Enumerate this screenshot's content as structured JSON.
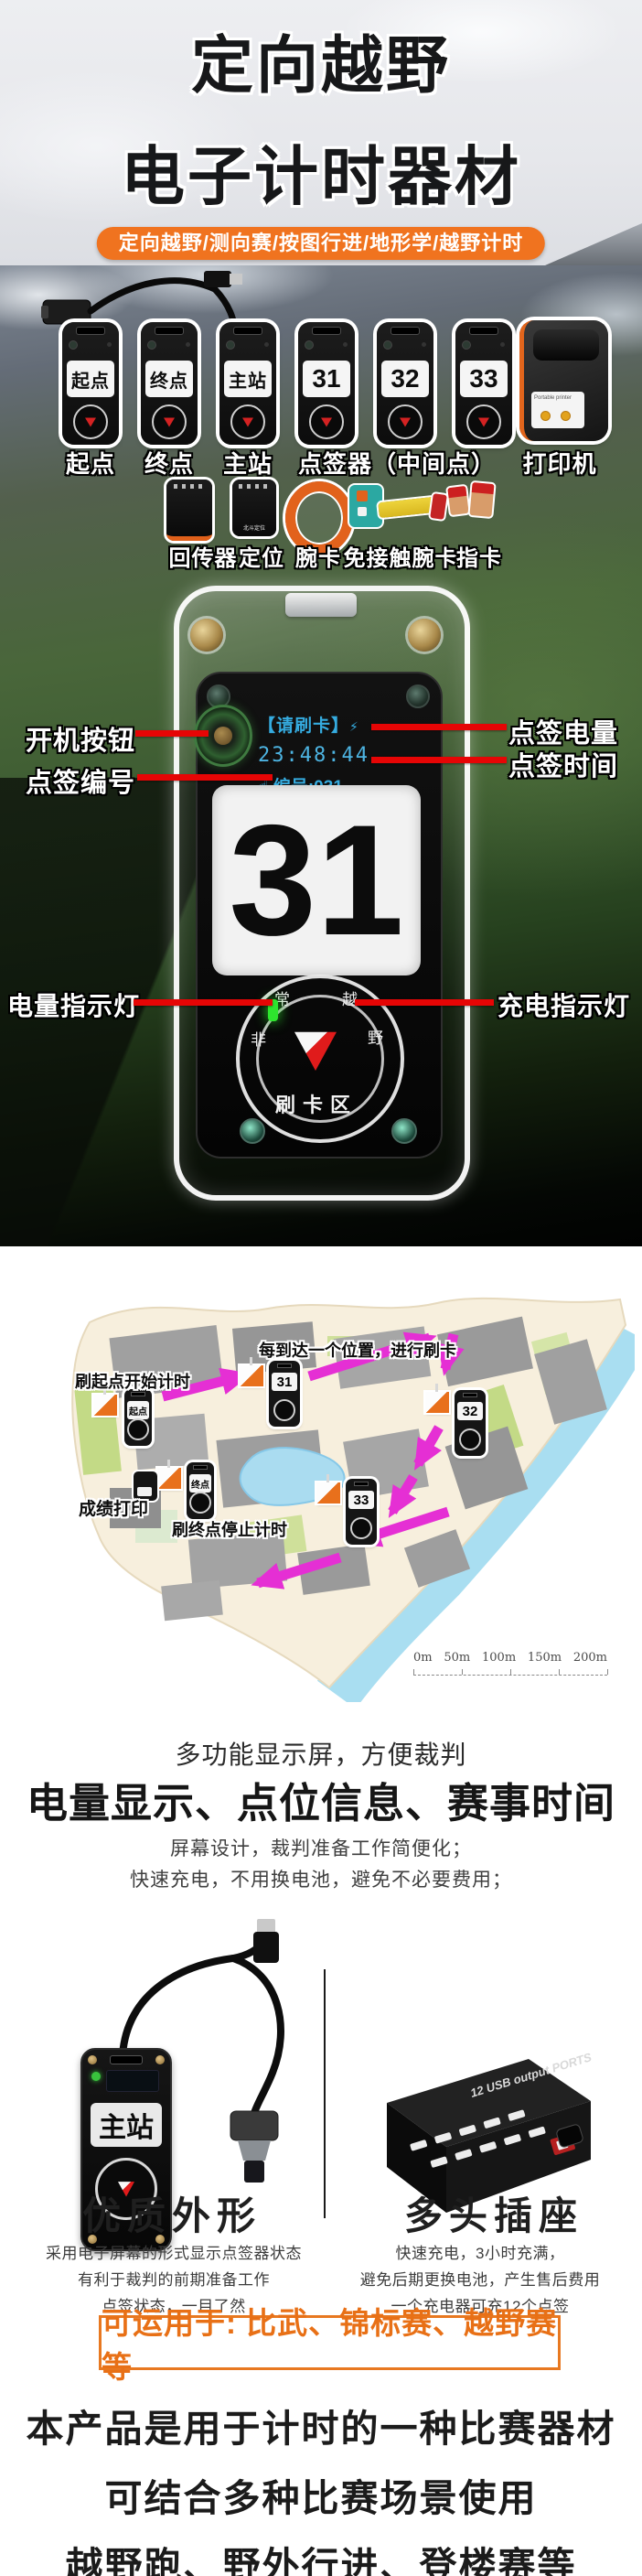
{
  "hero": {
    "title_line1": "定向越野",
    "title_line2": "电子计时器材",
    "banner": "定向越野/测向赛/按图行进/地形学/越野计时"
  },
  "lineup": {
    "station_labels": [
      "起点",
      "终点",
      "主站",
      "31",
      "32",
      "33"
    ],
    "printer_label": "Portable printer",
    "captions": [
      "起点",
      "终点",
      "主站",
      "点签器（中间点）",
      "打印机"
    ],
    "accessory_captions": [
      "回传器",
      "定位",
      "腕卡",
      "免接触腕卡",
      "指卡"
    ],
    "gps_text": "北斗定位"
  },
  "detail": {
    "screen_line1": "【请刷卡】",
    "screen_charge_icon": "⚡",
    "screen_line2": "23:48:44",
    "screen_line3_icon": "☝",
    "screen_line3": "编号:031",
    "number_plate": "31",
    "dial_chars": [
      "非",
      "常",
      "越",
      "野"
    ],
    "swipe_label": "刷卡区",
    "callouts": {
      "power": "开机按钮",
      "number": "点签编号",
      "battery": "点签电量",
      "time": "点签时间",
      "battery_led": "电量指示灯",
      "charge_led": "充电指示灯"
    }
  },
  "map": {
    "note_top": "每到达一个位置，进行刷卡",
    "note_start": "刷起点开始计时",
    "note_print": "成绩打印",
    "note_finish": "刷终点停止计时",
    "station_start": "起点",
    "station_31": "31",
    "station_32": "32",
    "station_33": "33",
    "station_finish": "终点",
    "scale_labels": [
      "0m",
      "50m",
      "100m",
      "150m",
      "200m"
    ]
  },
  "features": {
    "headline_small": "多功能显示屏，方便裁判",
    "headline_large": "电量显示、点位信息、赛事时间",
    "sub1": "屏幕设计，裁判准备工作简便化；",
    "sub2": "快速充电，不用换电池，避免不必要费用；"
  },
  "products": {
    "left": {
      "title": "优质外形",
      "screen_label": "主站",
      "desc_lines": [
        "采用电子屏幕的形式显示点签器状态",
        "有利于裁判的前期准备工作",
        "点签状态，一目了然"
      ]
    },
    "right": {
      "title": "多头插座",
      "device_text": "12 USB output PORTS",
      "desc_lines": [
        "快速充电，3小时充满，",
        "避免后期更换电池，产生售后费用",
        "一个充电器可充12个点签"
      ]
    }
  },
  "applications": "可运用于: 比武、锦标赛、越野赛等",
  "footer": [
    "本产品是用于计时的一种比赛器材",
    "可结合多种比赛场景使用",
    "越野跑、野外行进、登楼赛等"
  ],
  "colors": {
    "accent_orange": "#f0731f",
    "callout_red": "#e60505",
    "arrow_magenta": "#e52fd4",
    "screen_cyan": "#35abdf",
    "flag_orange": "#e8701c"
  }
}
